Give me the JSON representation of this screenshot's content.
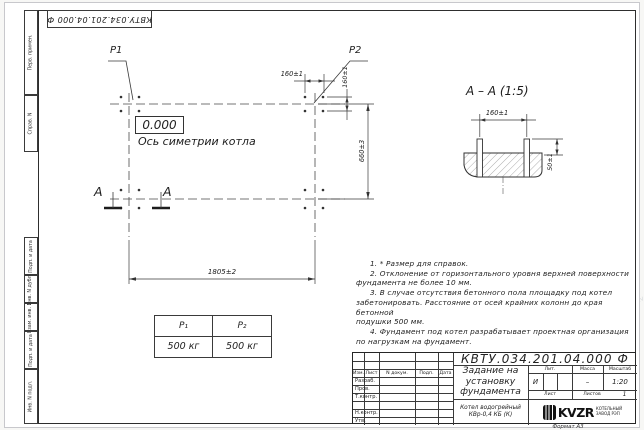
{
  "watermark": {
    "text": "kotlam-tev.kz"
  },
  "stamp_top": "КВТУ.034.201.04.000 Ф",
  "margin_labels": {
    "perv": "Перв. примен.",
    "sprav": "Справ. N",
    "podp1": "Подп. и дата",
    "inv_dubl": "Инв. N дубл.",
    "vzam": "Взам. инв. N",
    "podp2": "Подп. и дата",
    "inv_podl": "Инв. N подл."
  },
  "plan": {
    "p1": "P1",
    "p2": "P2",
    "level": "0.000",
    "axis_label": "Ось симетрии котла",
    "dim_160h": "160±1",
    "dim_160v": "160±1",
    "dim_660": "660±3",
    "dim_1805": "1805±2",
    "section_letter": "A"
  },
  "section": {
    "title": "A – A (1:5)",
    "dim_160": "160±1",
    "dim_50": "50±1"
  },
  "notes": {
    "lines": [
      "1. * Размер для справок.",
      "2. Отклонение от горизонтального уровня верхней поверхности",
      "фундамента не более 10 мм.",
      "3. В случае отсутствия бетонного пола площадку под котел",
      "забетонировать. Расстояние от осей крайних колонн до края бетонной",
      "подушки 500 мм.",
      "4. Фундамент под котел разрабатывает проектная организация",
      "по нагрузкам на фундамент."
    ]
  },
  "load_table": {
    "headers": [
      "P₁",
      "P₂"
    ],
    "values": [
      "500 кг",
      "500 кг"
    ]
  },
  "title_block": {
    "doc_number": "КВТУ.034.201.04.000 Ф",
    "title_lines": [
      "Задание на",
      "установку",
      "фундамента"
    ],
    "product_lines": [
      "Котел водогрейный",
      "КВр-0,4 КБ (К)"
    ],
    "columns": {
      "izm": "Изм.",
      "list": "Лист",
      "ndoc": "N докум.",
      "podp": "Подп.",
      "data": "Дата"
    },
    "rows": [
      "Разраб.",
      "Пров.",
      "Т.контр.",
      "",
      "Н.контр.",
      "Утв."
    ],
    "lit_label": "Лит.",
    "mass_label": "Масса",
    "scale_label": "Масштаб",
    "lit_value": "И",
    "mass_value": "–",
    "scale_value": "1:20",
    "sheet_label": "Лист",
    "sheets_label": "Листов",
    "sheets_value": "1",
    "logo_text": "KVZR",
    "logo_sub1": "КОТЕЛЬНЫЙ",
    "logo_sub2": "ЗАВОД РЭП",
    "format": "Формат А3"
  },
  "colors": {
    "line": "#3a3a3a",
    "hatch": "#8a8a8a"
  }
}
